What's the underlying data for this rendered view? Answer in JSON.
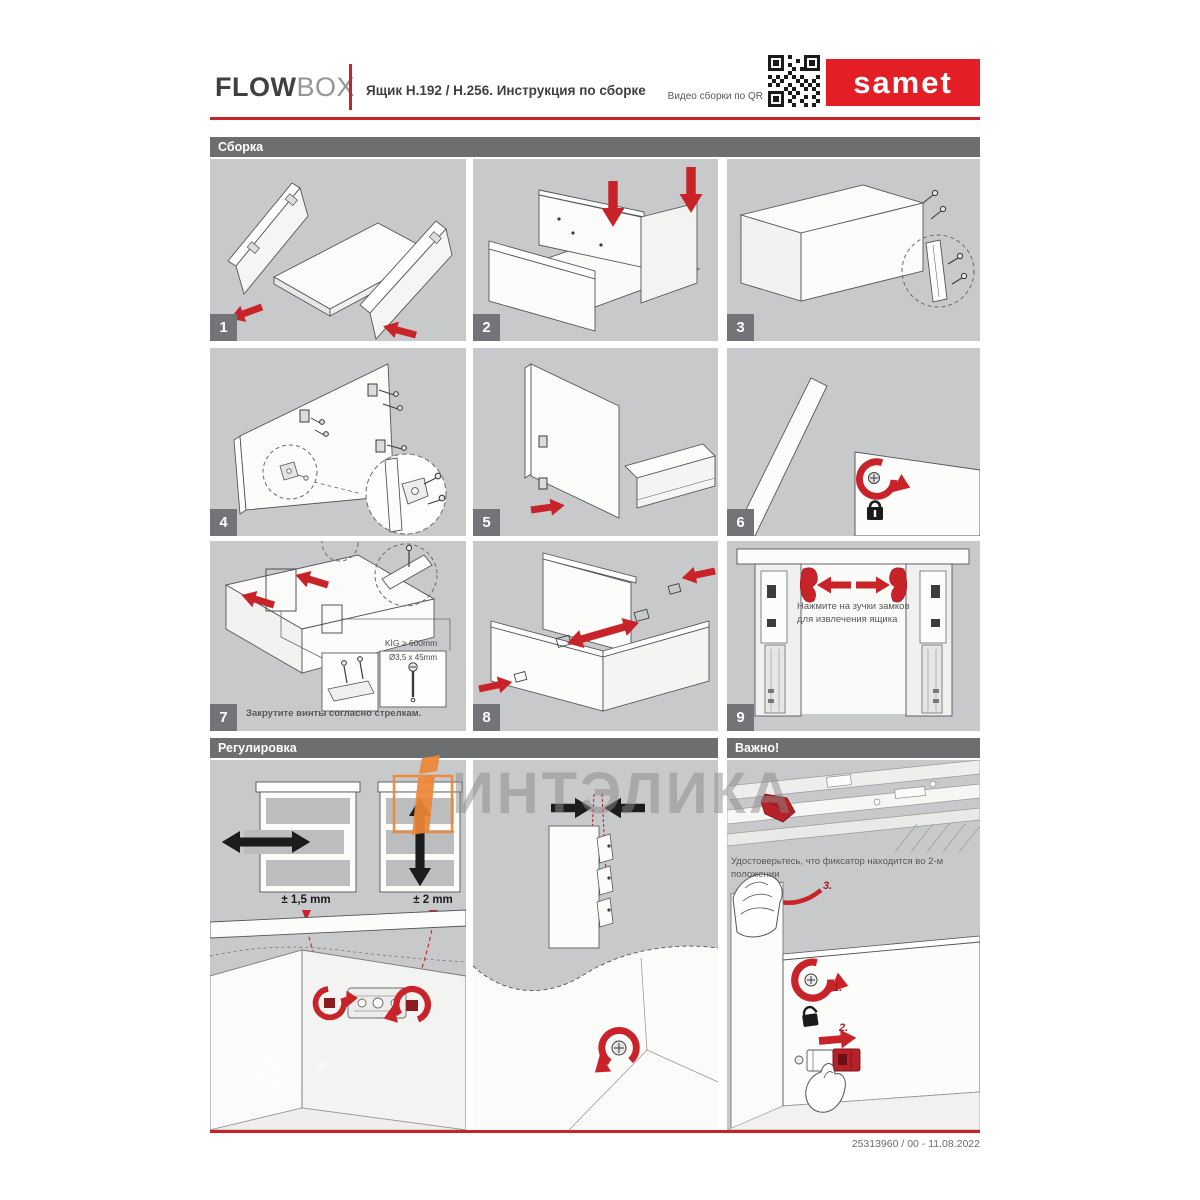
{
  "header": {
    "brand_primary": "FLOW",
    "brand_secondary": "BOX",
    "doc_title": "Ящик H.192 / H.256. Инструкция по сборке",
    "qr_caption": "Видео сборки по QR",
    "brand_logo": "samet"
  },
  "sections": {
    "assembly": "Сборка",
    "adjustment": "Регулировка",
    "important": "Важно!"
  },
  "steps": [
    {
      "num": "1"
    },
    {
      "num": "2"
    },
    {
      "num": "3"
    },
    {
      "num": "4"
    },
    {
      "num": "5"
    },
    {
      "num": "6"
    },
    {
      "num": "7",
      "caption": "Закрутите винты согласно стрелкам.",
      "kig_label": "KİG ≥ 600mm",
      "screw_label": "Ø3,5 x 45mm"
    },
    {
      "num": "8"
    },
    {
      "num": "9",
      "note": "Нажмите на зучки замков для извлечения ящика"
    }
  ],
  "adjustment": {
    "horizontal_range": "± 1,5 mm",
    "vertical_range": "± 2 mm"
  },
  "important": {
    "note": "Удостоверьтесь, что фиксатор находится во 2-м положении",
    "label_1": "1.",
    "label_2": "2.",
    "label_3": "3."
  },
  "watermark": {
    "text": "ИНТЭЛИКА",
    "digit": "8"
  },
  "footer": {
    "doc_code": "25313960 / 00 - 11.08.2022"
  },
  "colors": {
    "accent_red": "#c9232a",
    "brand_red": "#e31e24",
    "section_bar_gray": "#6d6e70",
    "panel_gray": "#c8c9cb",
    "watermark_orange": "#ee8636"
  }
}
